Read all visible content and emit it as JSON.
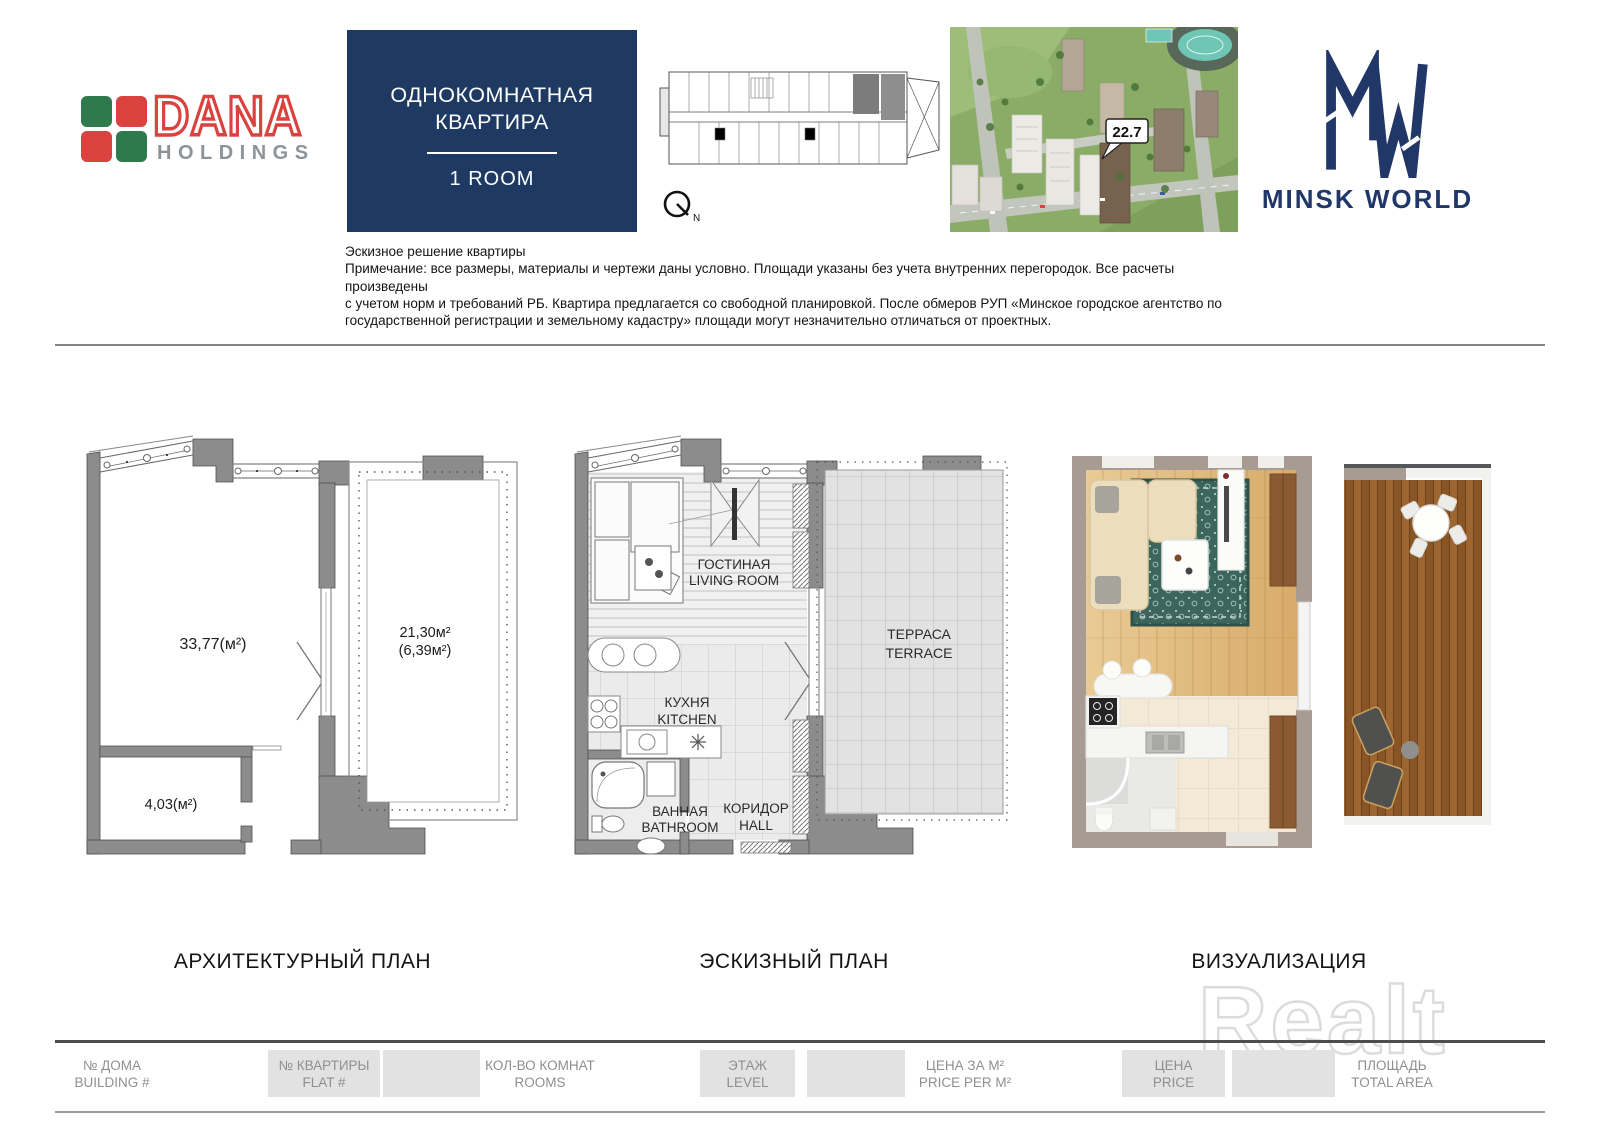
{
  "page": {
    "watermark": "Realt"
  },
  "header": {
    "dana": {
      "name": "DANA",
      "holdings": "HOLDINGS"
    },
    "title_box": {
      "ru_line1": "ОДНОКОМНАТНАЯ",
      "ru_line2": "КВАРТИРА",
      "en": "1 ROOM"
    },
    "compass": {
      "label": "N"
    },
    "aerial": {
      "badge": "22.7"
    },
    "minsk_world": {
      "wordmark": "MINSK WORLD"
    }
  },
  "notes": {
    "line1": "Эскизное решение квартиры",
    "line2": "Примечание: все размеры, материалы и чертежи даны условно. Площади указаны без учета внутренних перегородок. Все расчеты произведены",
    "line3": "с учетом норм и требований РБ. Квартира предлагается со свободной планировкой. После обмеров РУП «Минское городское агентство по",
    "line4": "государственной регистрации и земельному кадастру» площади могут незначительно отличаться от проектных."
  },
  "architectural_plan": {
    "caption": "АРХИТЕКТУРНЫЙ ПЛАН",
    "main_area": "33,77(м²)",
    "terrace_area": "21,30м²",
    "terrace_area_reduced": "(6,39м²)",
    "hall_area": "4,03(м²)"
  },
  "sketch_plan": {
    "caption": "ЭСКИЗНЫЙ ПЛАН",
    "living_ru": "ГОСТИНАЯ",
    "living_en": "LIVING ROOM",
    "terrace_ru": "ТЕРРАСА",
    "terrace_en": "TERRACE",
    "kitchen_ru": "КУХНЯ",
    "kitchen_en": "KITCHEN",
    "bathroom_ru": "ВАННАЯ",
    "bathroom_en": "BATHROOM",
    "hall_ru": "КОРИДОР",
    "hall_en": "HALL"
  },
  "visualization": {
    "caption": "ВИЗУАЛИЗАЦИЯ"
  },
  "footer": {
    "building_ru": "№ ДОМА",
    "building_en": "BUILDING #",
    "flat_ru": "№ КВАРТИРЫ",
    "flat_en": "FLAT #",
    "rooms_ru": "КОЛ-ВО КОМНАТ",
    "rooms_en": "ROOMS",
    "level_ru": "ЭТАЖ",
    "level_en": "LEVEL",
    "price_per_m2_ru": "ЦЕНА ЗА М²",
    "price_per_m2_en": "PRICE PER M²",
    "price_ru": "ЦЕНА",
    "price_en": "PRICE",
    "area_ru": "ПЛОЩАДЬ",
    "area_en": "TOTAL AREA"
  },
  "colors": {
    "brand_navy": "#1e3a63",
    "mw_navy": "#203768",
    "dana_red": "#d9423f",
    "dana_green": "#2f7a4c",
    "wall_gray": "#8c8c8c",
    "footer_cell_gray": "#e2e2e2"
  }
}
